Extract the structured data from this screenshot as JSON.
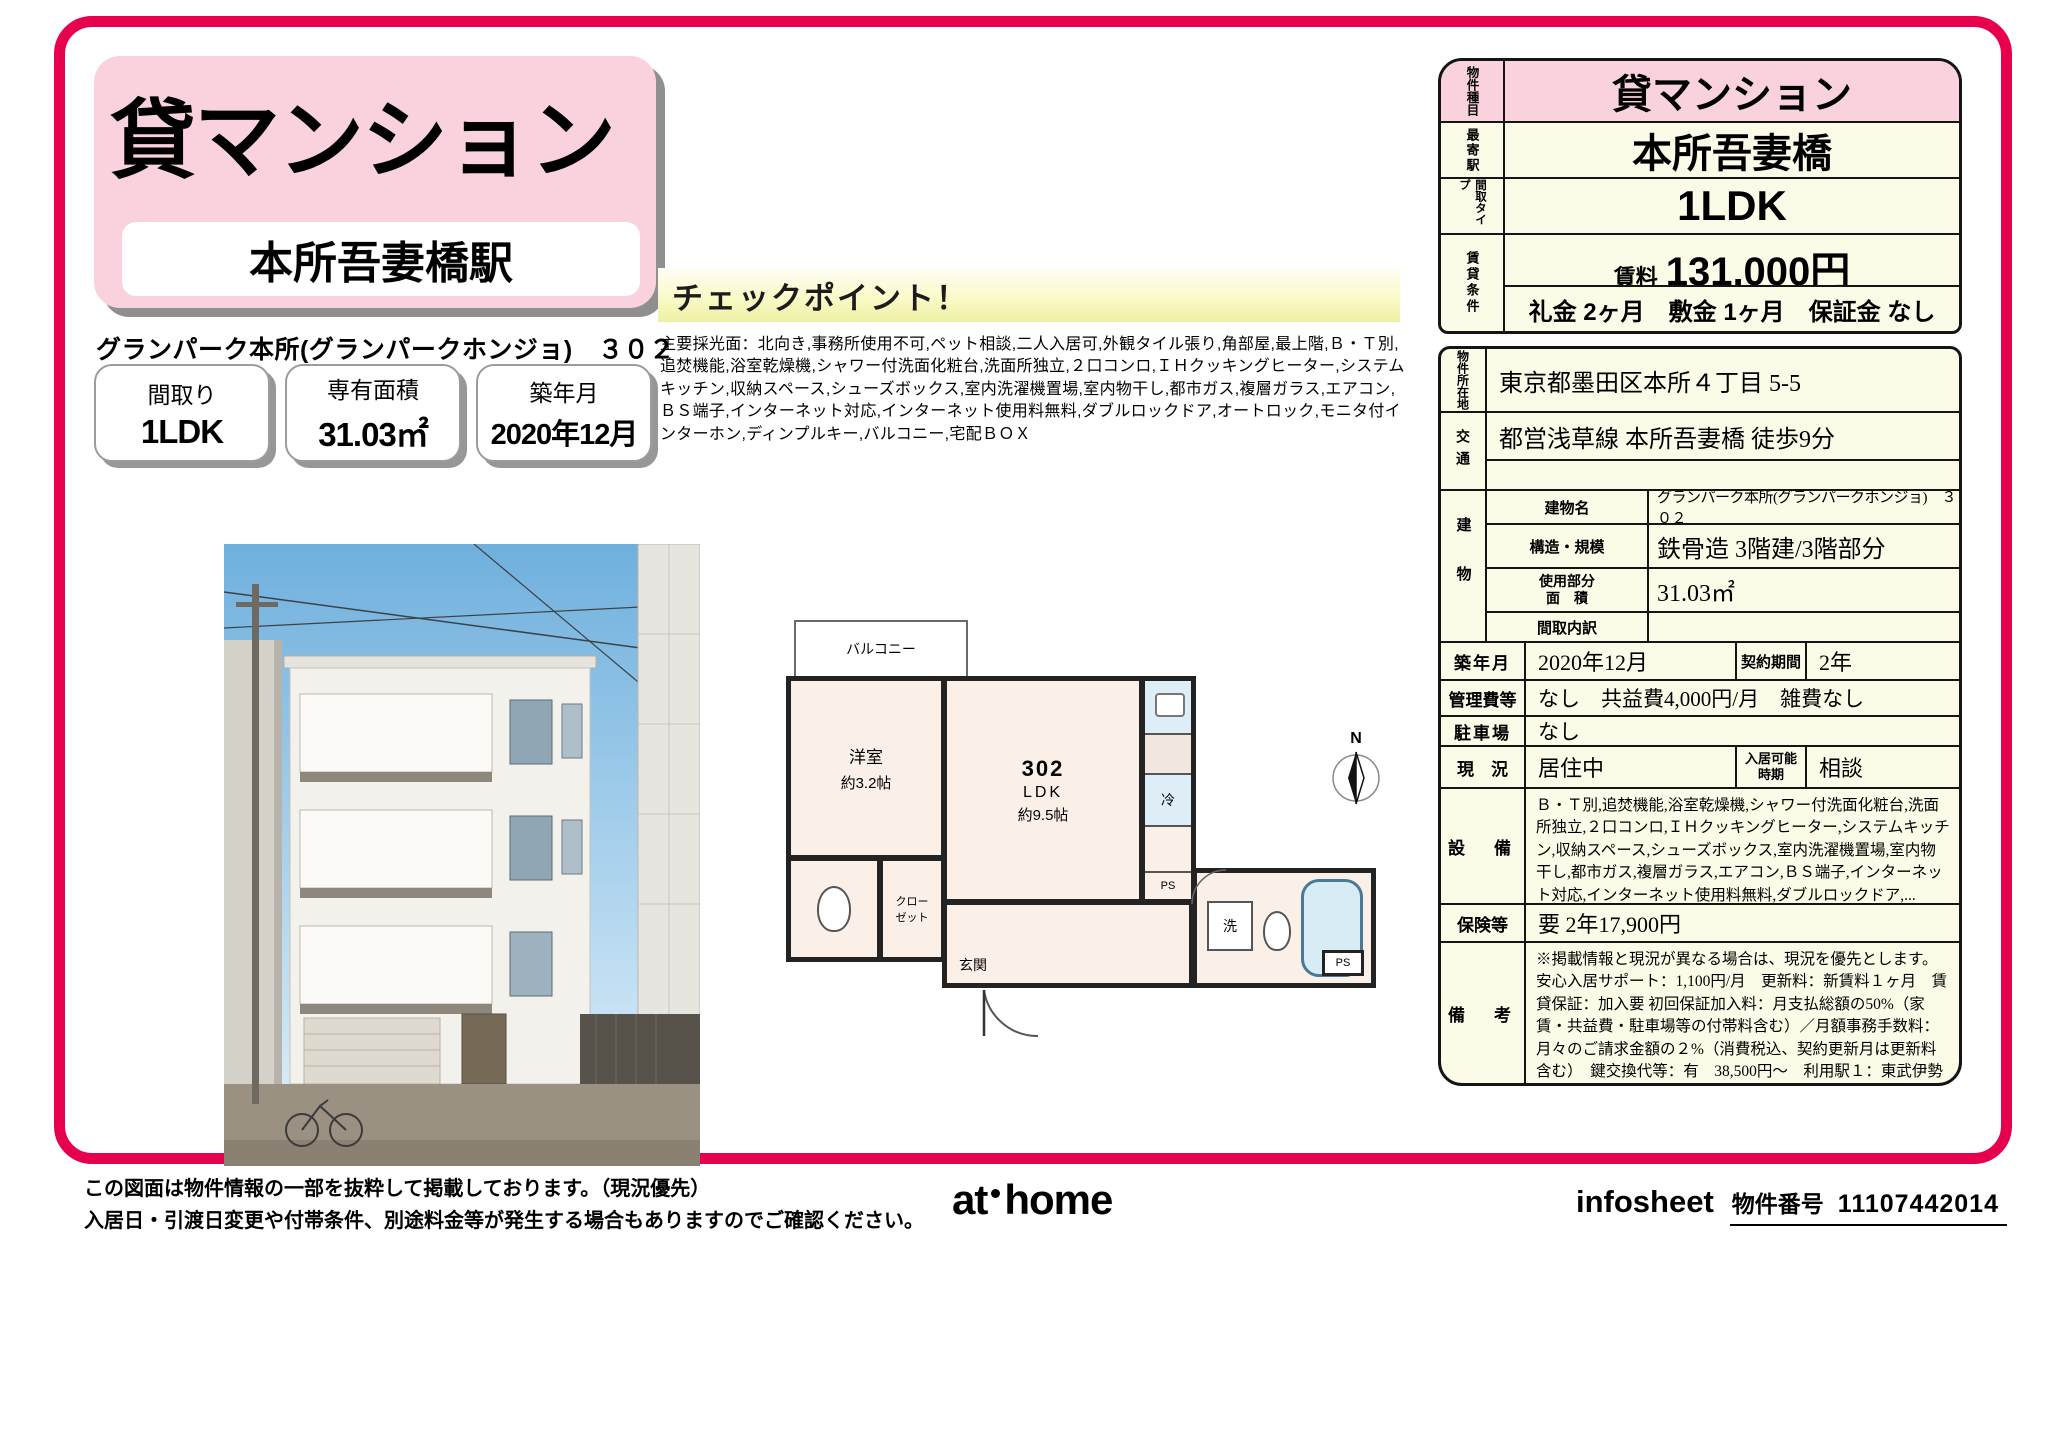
{
  "header": {
    "property_type": "貸マンション",
    "station": "本所吾妻橋駅",
    "building_line": "グランパーク本所(グランパークホンジョ)　３０２",
    "badges": [
      {
        "label": "間取り",
        "value": "1LDK"
      },
      {
        "label": "専有面積",
        "value": "31.03㎡"
      },
      {
        "label": "築年月",
        "value": "2020年12月"
      }
    ]
  },
  "checkpoint": {
    "title": "チェックポイント！",
    "body": "主要採光面：北向き,事務所使用不可,ペット相談,二人入居可,外観タイル張り,角部屋,最上階,Ｂ・Ｔ別,追焚機能,浴室乾燥機,シャワー付洗面化粧台,洗面所独立,２口コンロ,ＩＨクッキングヒーター,システムキッチン,収納スペース,シューズボックス,室内洗濯機置場,室内物干し,都市ガス,複層ガラス,エアコン,ＢＳ端子,インターネット対応,インターネット使用料無料,ダブルロックドア,オートロック,モニタ付インターホン,ディンプルキー,バルコニー,宅配ＢＯＸ"
  },
  "floorplan": {
    "balcony": "バルコニー",
    "room": "洋室",
    "room_size": "約3.2帖",
    "unit_no": "302",
    "ldk": "LDK",
    "ldk_size": "約9.5帖",
    "closet": "クロー\nゼット",
    "entrance": "玄関",
    "fridge": "冷",
    "washer": "洗",
    "ps_a": "PS",
    "ps_b": "PS",
    "compass": "N"
  },
  "summary": {
    "type_header": "物件種目",
    "type_value": "貸マンション",
    "station_header": "最寄駅",
    "station_value": "本所吾妻橋",
    "layout_header": "間取タイプ",
    "layout_value": "1LDK",
    "terms_header": "賃貸条件",
    "rent_label": "賃料",
    "rent_value": "131,000円",
    "terms_value": "礼金 2ヶ月　敷金 1ヶ月　保証金 なし"
  },
  "details": {
    "location_header": "物件所在地",
    "location": "東京都墨田区本所４丁目 5-5",
    "access_header": "交通",
    "access1": "都営浅草線 本所吾妻橋 徒歩9分",
    "access2": "",
    "building_header": "建物",
    "building_name_label": "建物名",
    "building_name": "グランパーク本所(グランパークホンジョ)　３０２",
    "structure_label": "構造・規模",
    "structure": "鉄骨造 3階建/3階部分",
    "area_label": "使用部分\n面　積",
    "area": "31.03㎡",
    "layout_detail_label": "間取内訳",
    "layout_detail": "",
    "built_label": "築年月",
    "built": "2020年12月",
    "contract_label": "契約期間",
    "contract": "2年",
    "fees_label": "管理費等",
    "fees": "なし　共益費4,000円/月　雑費なし",
    "parking_label": "駐車場",
    "parking": "なし",
    "status_label": "現　況",
    "status": "居住中",
    "movein_label": "入居可能\n時期",
    "movein": "相談",
    "equipment_label": "設　備",
    "equipment": "Ｂ・Ｔ別,追焚機能,浴室乾燥機,シャワー付洗面化粧台,洗面所独立,２口コンロ,ＩＨクッキングヒーター,システムキッチン,収納スペース,シューズボックス,室内洗濯機置場,室内物干し,都市ガス,複層ガラス,エアコン,ＢＳ端子,インターネット対応,インターネット使用料無料,ダブルロックドア,...",
    "insurance_label": "保険等",
    "insurance": "要 2年17,900円",
    "notes_label": "備　考",
    "notes": "※掲載情報と現況が異なる場合は、現況を優先とします。　安心入居サポート：1,100円/月　更新料：新賃料１ヶ月　賃貸保証：加入要 初回保証加入料：月支払総額の50%（家賃・共益費・駐車場等の付帯料含む）／月額事務手数料：月々のご請求金額の２%（消費税込、契約更新月は更新料含む）　鍵交換代等：有　38,500円～　利用駅１：東武伊勢崎・大師線 とうきょうスカイツリー 徒歩13分"
  },
  "footer": {
    "disclaimer1": "この図面は物件情報の一部を抜粋して掲載しております。（現況優先）",
    "disclaimer2": "入居日・引渡日変更や付帯条件、別途料金等が発生する場合もありますのでご確認ください。",
    "logo_at": "at",
    "logo_home": "home",
    "infosheet": "infosheet",
    "property_no_label": "物件番号",
    "property_no": "11107442014"
  }
}
